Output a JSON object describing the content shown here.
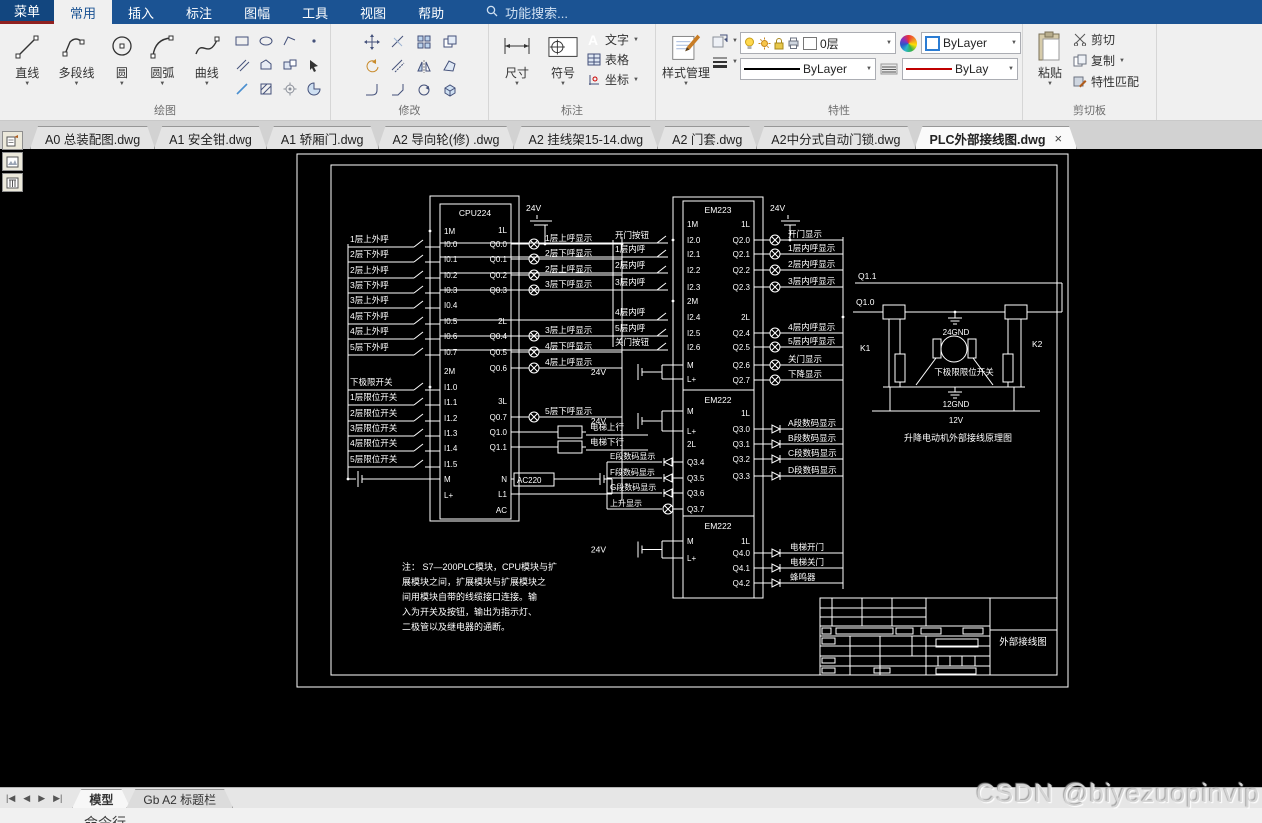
{
  "menu": {
    "items": [
      "菜单",
      "常用",
      "插入",
      "标注",
      "图幅",
      "工具",
      "视图",
      "帮助"
    ],
    "active": "常用",
    "search_placeholder": "功能搜索..."
  },
  "icons": {
    "close": "×",
    "dropdown": "▼",
    "text_tool_glyph": "A",
    "symbol_glyph": ".1"
  },
  "ribbon": {
    "draw_group": {
      "label": "绘图",
      "tools": [
        "直线",
        "多段线",
        "圆",
        "圆弧",
        "曲线"
      ]
    },
    "modify_group": {
      "label": "修改"
    },
    "annotate_group": {
      "label": "标注",
      "dim": "尺寸",
      "symbol": "符号",
      "stack": [
        "文字",
        "表格",
        "坐标"
      ]
    },
    "properties_group": {
      "label": "特性",
      "style_button": "样式管理",
      "layer_value": "0层",
      "color_value": "ByLayer",
      "linetype_value": "ByLayer",
      "lineweight_value": "ByLay"
    },
    "clipboard_group": {
      "label": "剪切板",
      "paste": "粘贴",
      "stack": [
        "剪切",
        "复制",
        "特性匹配"
      ]
    }
  },
  "doc_tabs": {
    "tabs": [
      "A0 总装配图.dwg",
      "A1 安全钳.dwg",
      "A1 轿厢门.dwg",
      "A2 导向轮(修) .dwg",
      "A2 挂线架15-14.dwg",
      "A2 门套.dwg",
      "A2中分式自动门锁.dwg",
      "PLC外部接线图.dwg"
    ],
    "active": "PLC外部接线图.dwg"
  },
  "bottom": {
    "layout_tabs": [
      "模型",
      "Gb A2 标题栏"
    ],
    "active": "模型",
    "command_label": "命令行"
  },
  "watermark": "CSDN @biyezuopinvip",
  "diagram": {
    "v24": "24V",
    "cpu": {
      "title": "CPU224",
      "left_pins": [
        "1M",
        "I0.0",
        "I0.1",
        "I0.2",
        "I0.3",
        "I0.4",
        "I0.5",
        "I0.6",
        "I0.7",
        "2M",
        "I1.0",
        "I1.1",
        "I1.2",
        "I1.3",
        "I1.4",
        "I1.5",
        "M",
        "L+"
      ],
      "right_pins": [
        "1L",
        "Q0.0",
        "Q0.1",
        "Q0.2",
        "Q0.3",
        "2L",
        "Q0.4",
        "Q0.5",
        "Q0.6",
        "3L",
        "Q0.7",
        "Q1.0",
        "Q1.1",
        "N",
        "L1",
        "AC"
      ],
      "floor_inputs": [
        "1层上外呼",
        "2层下外呼",
        "2层上外呼",
        "3层下外呼",
        "3层上外呼",
        "4层下外呼",
        "4层上外呼",
        "5层下外呼"
      ],
      "limit_inputs": [
        "下极限开关",
        "1层限位开关",
        "2层限位开关",
        "3层限位开关",
        "4层限位开关",
        "5层限位开关"
      ],
      "lamp_outputs_1": [
        "1层上呼显示",
        "2层下呼显示",
        "2层上呼显示",
        "3层下呼显示"
      ],
      "lamp_outputs_2": [
        "3层上呼显示",
        "4层下呼显示",
        "4层上呼显示"
      ],
      "lamp_outputs_3": [
        "5层下呼显示"
      ],
      "relay_outputs": [
        "电梯上行",
        "电梯下行"
      ],
      "ac_label": "AC220"
    },
    "em223": {
      "title": "EM223",
      "left_pins": [
        "1M",
        "I2.0",
        "I2.1",
        "I2.2",
        "I2.3",
        "2M",
        "I2.4",
        "I2.5",
        "I2.6",
        "M",
        "L+"
      ],
      "right_pins": [
        "1L",
        "Q2.0",
        "Q2.1",
        "Q2.2",
        "Q2.3",
        "2L",
        "Q2.4",
        "Q2.5",
        "Q2.6",
        "Q2.7"
      ],
      "inputs": [
        "开门按钮",
        "1层内呼",
        "2层内呼",
        "3层内呼",
        "4层内呼",
        "5层内呼",
        "关门按钮"
      ],
      "outputs": [
        "开门显示",
        "1层内呼显示",
        "2层内呼显示",
        "3层内呼显示",
        "4层内呼显示",
        "5层内呼显示",
        "关门显示",
        "下降显示"
      ]
    },
    "em222a": {
      "title": "EM222",
      "left_pins": [
        "M",
        "L+",
        "2L",
        "Q3.4",
        "Q3.5",
        "Q3.6",
        "Q3.7"
      ],
      "right_pins": [
        "1L",
        "Q3.0",
        "Q3.1",
        "Q3.2",
        "Q3.3"
      ],
      "left_outputs": [
        "E段数码显示",
        "F段数码显示",
        "G段数码显示",
        "上升显示"
      ],
      "right_outputs": [
        "A段数码显示",
        "B段数码显示",
        "C段数码显示",
        "D段数码显示"
      ]
    },
    "em222b": {
      "title": "EM222",
      "left_pins": [
        "M",
        "L+"
      ],
      "right_pins": [
        "1L",
        "Q4.0",
        "Q4.1",
        "Q4.2"
      ],
      "outputs": [
        "电梯开门",
        "电梯关门",
        "蜂鸣器"
      ]
    },
    "motor": {
      "q11": "Q1.1",
      "q10": "Q1.0",
      "gnd24": "24GND",
      "k1": "K1",
      "k2": "K2",
      "limit": "下极限限位开关",
      "gnd12": "12GND",
      "v12": "12V",
      "caption": "升降电动机外部接线原理图"
    },
    "note_lines": [
      "注：  S7—200PLC模块，CPU模块与扩",
      "展模块之间，扩展模块与扩展模块之",
      "间用模块自带的线缆接口连接。输",
      "入为开关及按钮，输出为指示灯、",
      "二极管以及继电器的通断。"
    ],
    "title_block": "外部接线图"
  }
}
